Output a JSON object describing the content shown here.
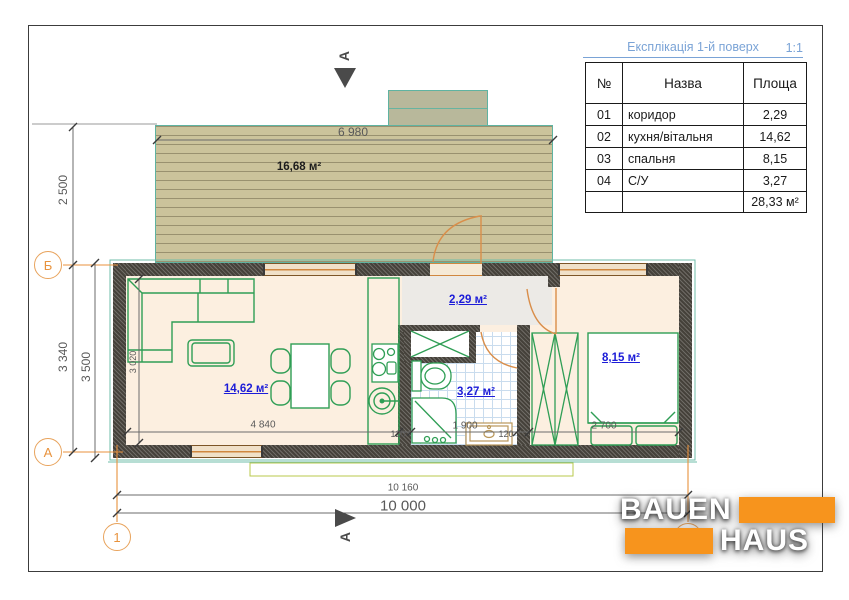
{
  "legend": {
    "title": "Експлікація 1-й поверх",
    "scale": "1:1",
    "col_num": "№",
    "col_name": "Назва",
    "col_area": "Площа",
    "rows": [
      {
        "num": "01",
        "name": "коридор",
        "area": "2,29"
      },
      {
        "num": "02",
        "name": "кухня/вітальня",
        "area": "14,62"
      },
      {
        "num": "03",
        "name": "спальня",
        "area": "8,15"
      },
      {
        "num": "04",
        "name": "С/У",
        "area": "3,27"
      }
    ],
    "total_area": "28,33 м²"
  },
  "plan": {
    "deck_area_label": "16,68 м²",
    "room_labels": {
      "corridor": "2,29 м²",
      "kitchen_living": "14,62 м²",
      "bathroom": "3,27 м²",
      "bedroom": "8,15 м²"
    },
    "dimensions": {
      "deck_width": "6 980",
      "deck_depth": "2 500",
      "axis_span": "3 340",
      "building_depth": "3 500",
      "living_depth": "3 020",
      "living_width": "4 840",
      "wall_left": "120",
      "bath_width": "1 900",
      "wall_right": "120",
      "bedroom_width": "2 700",
      "overall_with_walls": "10 160",
      "overall": "10 000"
    },
    "axes": {
      "top_row": "Б",
      "bottom_row": "А",
      "col_1": "1"
    },
    "section_label_top": "А",
    "section_label_bottom": "А"
  },
  "logo": {
    "line1": "BAUEN",
    "line2": "HAUS"
  },
  "colors": {
    "logo_orange": "#f7941d",
    "furniture_green": "#2f9e55",
    "room_label_blue": "#1c1cd8",
    "legend_title_blue": "#7aa3d6",
    "deck_tan": "#cbc39b",
    "wall_dark": "#45413a",
    "axis_orange": "#e8923c"
  }
}
